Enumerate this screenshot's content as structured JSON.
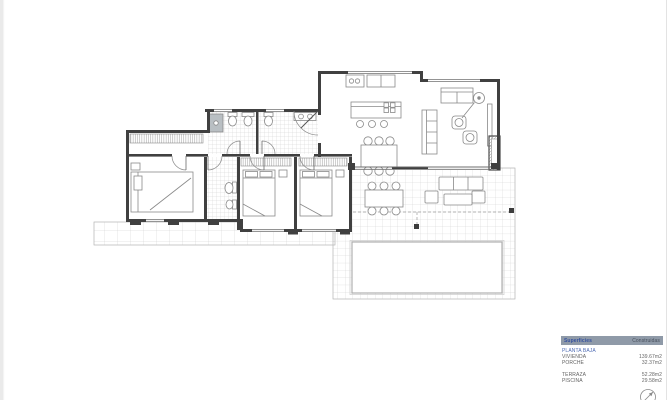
{
  "document": {
    "type": "architectural-floor-plan",
    "sheet_background": "#ffffff"
  },
  "colors": {
    "wall": "#404040",
    "furniture_line": "#898989",
    "tile_line": "#cccccc",
    "legend_header_bg": "#8f9aa8",
    "legend_header_col1": "#35519e",
    "legend_header_col2": "#474f5c",
    "legend_accent_blue": "#4f6cb4",
    "legend_text": "#636363"
  },
  "legend": {
    "col_headers": [
      "Superficies",
      "Construidas"
    ],
    "sections": [
      {
        "title": "PLANTA BAJA",
        "rows": [
          [
            "VIVIENDA",
            "139.67m2"
          ],
          [
            "PORCHE",
            "32.37m2"
          ]
        ]
      },
      {
        "title": "",
        "rows": [
          [
            "TERRAZA",
            "52.28m2"
          ],
          [
            "PISCINA",
            "29.58m2"
          ]
        ]
      }
    ]
  },
  "icons": {
    "compass": "north-arrow"
  },
  "plan_features": [
    "bedroom-1",
    "bedroom-2",
    "bedroom-3",
    "bathroom-1",
    "bathroom-2",
    "bathroom-3",
    "corridor-wardrobe",
    "kitchen-island",
    "kitchen-counter",
    "dining-table",
    "sofa",
    "loveseat",
    "armchairs",
    "floor-lamp",
    "fireplace",
    "porch",
    "terrace",
    "outdoor-dining-table",
    "outdoor-lounge-set",
    "pool"
  ]
}
